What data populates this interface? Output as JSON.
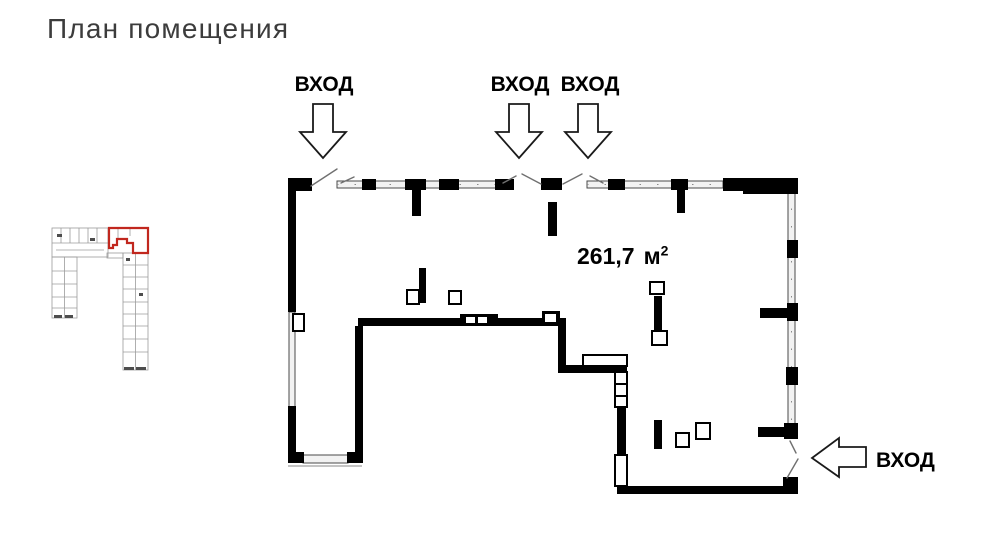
{
  "page": {
    "title": "План помещения"
  },
  "plan": {
    "area": {
      "value": "261,7",
      "unit": "м",
      "sup": "2"
    },
    "entrances": [
      {
        "id": "top-left",
        "label": "ВХОД",
        "direction": "down"
      },
      {
        "id": "top-center",
        "label": "ВХОД",
        "direction": "down"
      },
      {
        "id": "top-right",
        "label": "ВХОД",
        "direction": "down"
      },
      {
        "id": "right-bottom",
        "label": "ВХОД",
        "direction": "left"
      }
    ],
    "colors": {
      "wall": "#000000",
      "window_fill": "#f2f2f2",
      "window_stroke": "#4a4a4a",
      "door_line": "#707070",
      "arrow_fill": "#ffffff",
      "arrow_outline": "#1a1a1a",
      "title_text": "#3c3c3c",
      "label_text": "#000000",
      "minimap_line": "#9b9b9b",
      "minimap_dark": "#4d4d4d",
      "minimap_highlight": "#c1271e",
      "background": "#ffffff"
    }
  }
}
